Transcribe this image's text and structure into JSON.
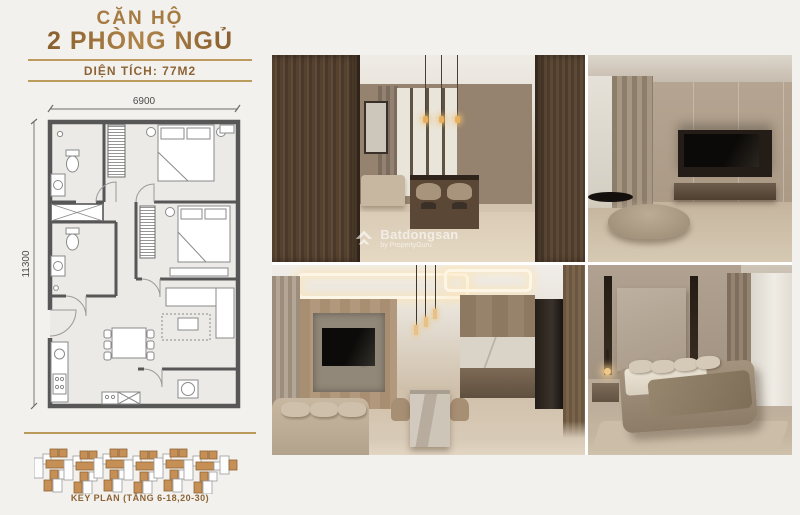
{
  "header": {
    "title_line1": "CĂN HỘ",
    "title_line2": "2 PHÒNG NGỦ",
    "area_label": "DIỆN TÍCH: 77M2"
  },
  "floor_plan": {
    "width_dim": "6900",
    "height_dim": "11300"
  },
  "key_plan": {
    "caption": "KEY PLAN (TẦNG 6-18,20-30)"
  },
  "watermark": {
    "brand": "Batdongsan",
    "byline": "by PropertyGuru"
  },
  "colors": {
    "accent_gold": "#bb9b5e",
    "title_bronze": "#8d6436",
    "keyplan_unit": "#c58f55",
    "plan_wall": "#575757"
  }
}
